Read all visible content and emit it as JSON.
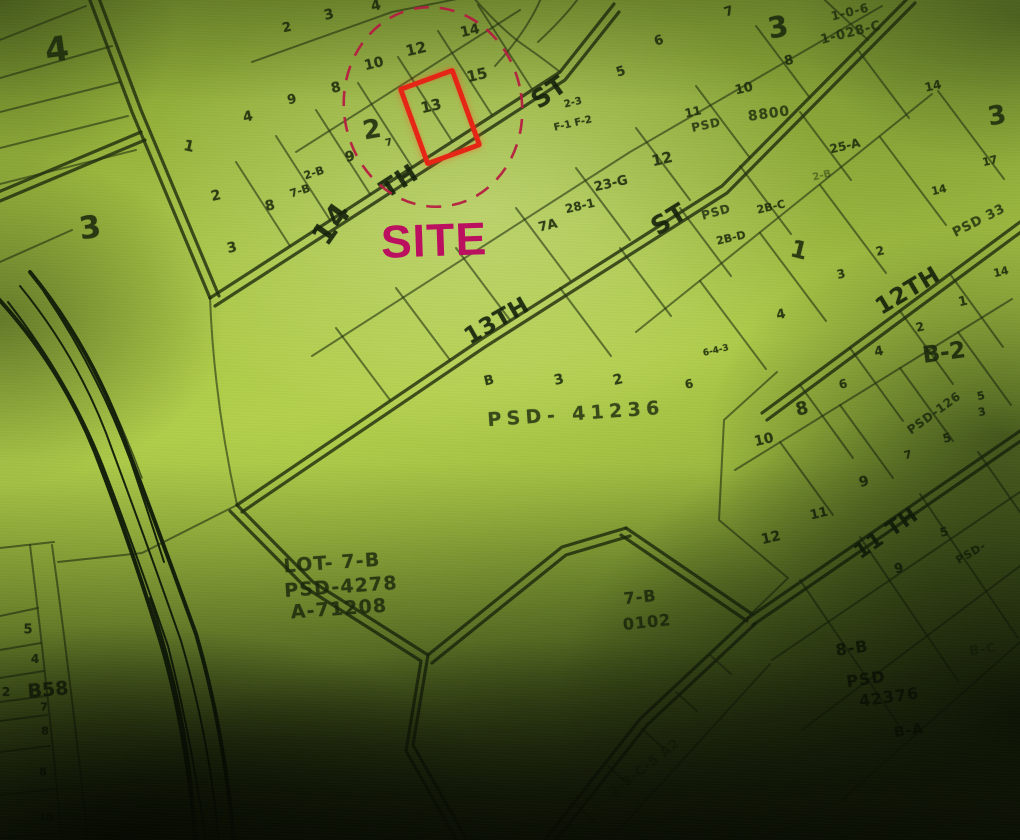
{
  "site": {
    "label": "SITE",
    "lot": "13"
  },
  "colors": {
    "ink": "#1b2a0c",
    "site_box": "#e52616",
    "site_circle": "#b51d41",
    "site_text": "#bb0f60",
    "paper_light": "#aac746",
    "paper_dark": "#1a240a"
  },
  "map": {
    "labels": [
      {
        "t": "14",
        "x": 332,
        "y": 224,
        "s": 30,
        "r": -55,
        "c": "street"
      },
      {
        "t": "TH",
        "x": 399,
        "y": 181,
        "s": 25,
        "r": -33,
        "c": "street"
      },
      {
        "t": "ST",
        "x": 549,
        "y": 92,
        "s": 25,
        "r": -35,
        "c": "street"
      },
      {
        "t": "13TH",
        "x": 497,
        "y": 321,
        "s": 23,
        "r": -30,
        "c": "street"
      },
      {
        "t": "ST",
        "x": 669,
        "y": 219,
        "s": 25,
        "r": -32,
        "c": "street"
      },
      {
        "t": "12TH",
        "x": 908,
        "y": 291,
        "s": 23,
        "r": -31,
        "c": "street"
      },
      {
        "t": "11 TH",
        "x": 886,
        "y": 533,
        "s": 21,
        "r": -35,
        "c": "street"
      },
      {
        "t": "4",
        "x": 57,
        "y": 50,
        "s": 34,
        "r": -8
      },
      {
        "t": "3",
        "x": 90,
        "y": 228,
        "s": 31,
        "r": -8
      },
      {
        "t": "3",
        "x": 778,
        "y": 27,
        "s": 29,
        "r": -10
      },
      {
        "t": "3",
        "x": 997,
        "y": 116,
        "s": 26,
        "r": -10
      },
      {
        "t": "2",
        "x": 372,
        "y": 130,
        "s": 26,
        "r": -10
      },
      {
        "t": "1",
        "x": 799,
        "y": 250,
        "s": 24,
        "r": 14
      },
      {
        "t": "B-2",
        "x": 944,
        "y": 353,
        "s": 23,
        "r": -8
      },
      {
        "t": "B58",
        "x": 48,
        "y": 690,
        "s": 19,
        "r": -5
      },
      {
        "t": "2",
        "x": 287,
        "y": 28,
        "s": 13
      },
      {
        "t": "3",
        "x": 329,
        "y": 15,
        "s": 14
      },
      {
        "t": "4",
        "x": 376,
        "y": 6,
        "s": 14
      },
      {
        "t": "9",
        "x": 292,
        "y": 100,
        "s": 13
      },
      {
        "t": "4",
        "x": 248,
        "y": 117,
        "s": 14
      },
      {
        "t": "1",
        "x": 189,
        "y": 146,
        "s": 15,
        "r": 12
      },
      {
        "t": "2",
        "x": 216,
        "y": 196,
        "s": 14
      },
      {
        "t": "8",
        "x": 270,
        "y": 206,
        "s": 14
      },
      {
        "t": "3",
        "x": 232,
        "y": 248,
        "s": 14
      },
      {
        "t": "8",
        "x": 336,
        "y": 88,
        "s": 14
      },
      {
        "t": "10",
        "x": 374,
        "y": 64,
        "s": 14
      },
      {
        "t": "12",
        "x": 416,
        "y": 49,
        "s": 15
      },
      {
        "t": "14",
        "x": 470,
        "y": 31,
        "s": 14
      },
      {
        "t": "15",
        "x": 477,
        "y": 75,
        "s": 15
      },
      {
        "t": "13",
        "x": 431,
        "y": 106,
        "s": 15
      },
      {
        "t": "7",
        "x": 389,
        "y": 143,
        "s": 10
      },
      {
        "t": "9",
        "x": 350,
        "y": 157,
        "s": 14
      },
      {
        "t": "2-B",
        "x": 314,
        "y": 173,
        "s": 11,
        "r": -18
      },
      {
        "t": "7-B",
        "x": 300,
        "y": 191,
        "s": 11,
        "r": -18
      },
      {
        "t": "7",
        "x": 729,
        "y": 12,
        "s": 13,
        "r": -18
      },
      {
        "t": "6",
        "x": 659,
        "y": 41,
        "s": 13,
        "r": -18
      },
      {
        "t": "5",
        "x": 621,
        "y": 72,
        "s": 13,
        "r": -18
      },
      {
        "t": "10",
        "x": 744,
        "y": 89,
        "s": 13
      },
      {
        "t": "11",
        "x": 693,
        "y": 112,
        "s": 12
      },
      {
        "t": "8",
        "x": 789,
        "y": 61,
        "s": 13
      },
      {
        "t": "2-3",
        "x": 573,
        "y": 103,
        "s": 10
      },
      {
        "t": "F-1 F-2",
        "x": 573,
        "y": 124,
        "s": 10
      },
      {
        "t": "12",
        "x": 662,
        "y": 159,
        "s": 15
      },
      {
        "t": "23-G",
        "x": 611,
        "y": 184,
        "s": 13
      },
      {
        "t": "28-1",
        "x": 580,
        "y": 206,
        "s": 12
      },
      {
        "t": "7A",
        "x": 548,
        "y": 226,
        "s": 13
      },
      {
        "t": "2-B",
        "x": 822,
        "y": 176,
        "s": 10,
        "c": "lot faint"
      },
      {
        "t": "2B-C",
        "x": 771,
        "y": 207,
        "s": 11
      },
      {
        "t": "2B-D",
        "x": 731,
        "y": 238,
        "s": 11
      },
      {
        "t": "25-A",
        "x": 845,
        "y": 146,
        "s": 12
      },
      {
        "t": "14",
        "x": 933,
        "y": 86,
        "s": 12
      },
      {
        "t": "17",
        "x": 990,
        "y": 161,
        "s": 11
      },
      {
        "t": "14",
        "x": 939,
        "y": 190,
        "s": 11
      },
      {
        "t": "2",
        "x": 880,
        "y": 251,
        "s": 12
      },
      {
        "t": "3",
        "x": 841,
        "y": 274,
        "s": 12
      },
      {
        "t": "1",
        "x": 963,
        "y": 302,
        "s": 13
      },
      {
        "t": "2",
        "x": 920,
        "y": 327,
        "s": 12
      },
      {
        "t": "4",
        "x": 781,
        "y": 315,
        "s": 13
      },
      {
        "t": "4",
        "x": 879,
        "y": 352,
        "s": 13
      },
      {
        "t": "14",
        "x": 1001,
        "y": 272,
        "s": 11
      },
      {
        "t": "6-4-3",
        "x": 716,
        "y": 351,
        "s": 9
      },
      {
        "t": "6",
        "x": 843,
        "y": 384,
        "s": 12
      },
      {
        "t": "8",
        "x": 802,
        "y": 409,
        "s": 18
      },
      {
        "t": "10",
        "x": 764,
        "y": 440,
        "s": 14
      },
      {
        "t": "9",
        "x": 864,
        "y": 482,
        "s": 14
      },
      {
        "t": "11",
        "x": 819,
        "y": 514,
        "s": 13
      },
      {
        "t": "12",
        "x": 771,
        "y": 538,
        "s": 14
      },
      {
        "t": "5",
        "x": 947,
        "y": 438,
        "s": 12
      },
      {
        "t": "5",
        "x": 981,
        "y": 396,
        "s": 11
      },
      {
        "t": "3",
        "x": 982,
        "y": 412,
        "s": 11
      },
      {
        "t": "7",
        "x": 908,
        "y": 455,
        "s": 11
      },
      {
        "t": "5",
        "x": 944,
        "y": 532,
        "s": 12
      },
      {
        "t": "9",
        "x": 899,
        "y": 569,
        "s": 13
      },
      {
        "t": "B",
        "x": 489,
        "y": 381,
        "s": 13
      },
      {
        "t": "3",
        "x": 559,
        "y": 380,
        "s": 14
      },
      {
        "t": "2",
        "x": 618,
        "y": 380,
        "s": 14
      },
      {
        "t": "6",
        "x": 689,
        "y": 384,
        "s": 12
      },
      {
        "t": "5",
        "x": 28,
        "y": 630,
        "s": 13,
        "r": 0
      },
      {
        "t": "4",
        "x": 35,
        "y": 659,
        "s": 12,
        "r": 0
      },
      {
        "t": "2",
        "x": 6,
        "y": 692,
        "s": 12,
        "r": 0
      },
      {
        "t": "7",
        "x": 44,
        "y": 707,
        "s": 11,
        "r": 0
      },
      {
        "t": "8",
        "x": 45,
        "y": 731,
        "s": 11,
        "r": 0
      },
      {
        "t": "8",
        "x": 43,
        "y": 772,
        "s": 11,
        "r": 0
      },
      {
        "t": "10",
        "x": 46,
        "y": 818,
        "s": 10,
        "r": 0
      },
      {
        "t": "PSD",
        "x": 706,
        "y": 125,
        "s": 12,
        "r": -12,
        "c": "psd"
      },
      {
        "t": "8800",
        "x": 769,
        "y": 114,
        "s": 14,
        "r": -8,
        "c": "psd"
      },
      {
        "t": "1-0-6",
        "x": 850,
        "y": 12,
        "s": 12,
        "r": -14,
        "c": "psd"
      },
      {
        "t": "1-028-C",
        "x": 851,
        "y": 33,
        "s": 13,
        "r": -14,
        "c": "psd"
      },
      {
        "t": "PSD",
        "x": 716,
        "y": 212,
        "s": 12,
        "r": -15,
        "c": "psd"
      },
      {
        "t": "PSD 33",
        "x": 979,
        "y": 221,
        "s": 13,
        "r": -27,
        "c": "psd"
      },
      {
        "t": "PSD-126",
        "x": 934,
        "y": 413,
        "s": 12,
        "r": -36,
        "c": "psd"
      },
      {
        "t": "PSD-",
        "x": 971,
        "y": 553,
        "s": 11,
        "r": -30,
        "c": "psd"
      },
      {
        "t": "PSD- 41236",
        "x": 576,
        "y": 414,
        "s": 19,
        "r": -4,
        "c": "psd wide"
      },
      {
        "t": "LOT- 7-B",
        "x": 332,
        "y": 563,
        "s": 19,
        "r": -4,
        "c": "psd"
      },
      {
        "t": "PSD-4278",
        "x": 341,
        "y": 587,
        "s": 19,
        "r": -4,
        "c": "psd"
      },
      {
        "t": "A-71208",
        "x": 339,
        "y": 609,
        "s": 19,
        "r": -4,
        "c": "psd"
      },
      {
        "t": "7-B",
        "x": 640,
        "y": 597,
        "s": 16,
        "r": -6,
        "c": "psd"
      },
      {
        "t": "0102",
        "x": 647,
        "y": 622,
        "s": 16,
        "r": -6,
        "c": "psd"
      },
      {
        "t": "8-B",
        "x": 852,
        "y": 648,
        "s": 16,
        "r": -8,
        "c": "psd dark"
      },
      {
        "t": "PSD",
        "x": 866,
        "y": 679,
        "s": 16,
        "r": -8,
        "c": "psd dark"
      },
      {
        "t": "42376",
        "x": 889,
        "y": 697,
        "s": 16,
        "r": -8,
        "c": "psd dark"
      },
      {
        "t": "B-A",
        "x": 909,
        "y": 731,
        "s": 14,
        "r": -8,
        "c": "psd dark"
      },
      {
        "t": "B-C",
        "x": 983,
        "y": 650,
        "s": 13,
        "r": -8,
        "c": "psd faint"
      },
      {
        "t": "2-3-C-5 A2",
        "x": 645,
        "y": 768,
        "s": 13,
        "r": -38,
        "c": "psd faint"
      }
    ]
  }
}
